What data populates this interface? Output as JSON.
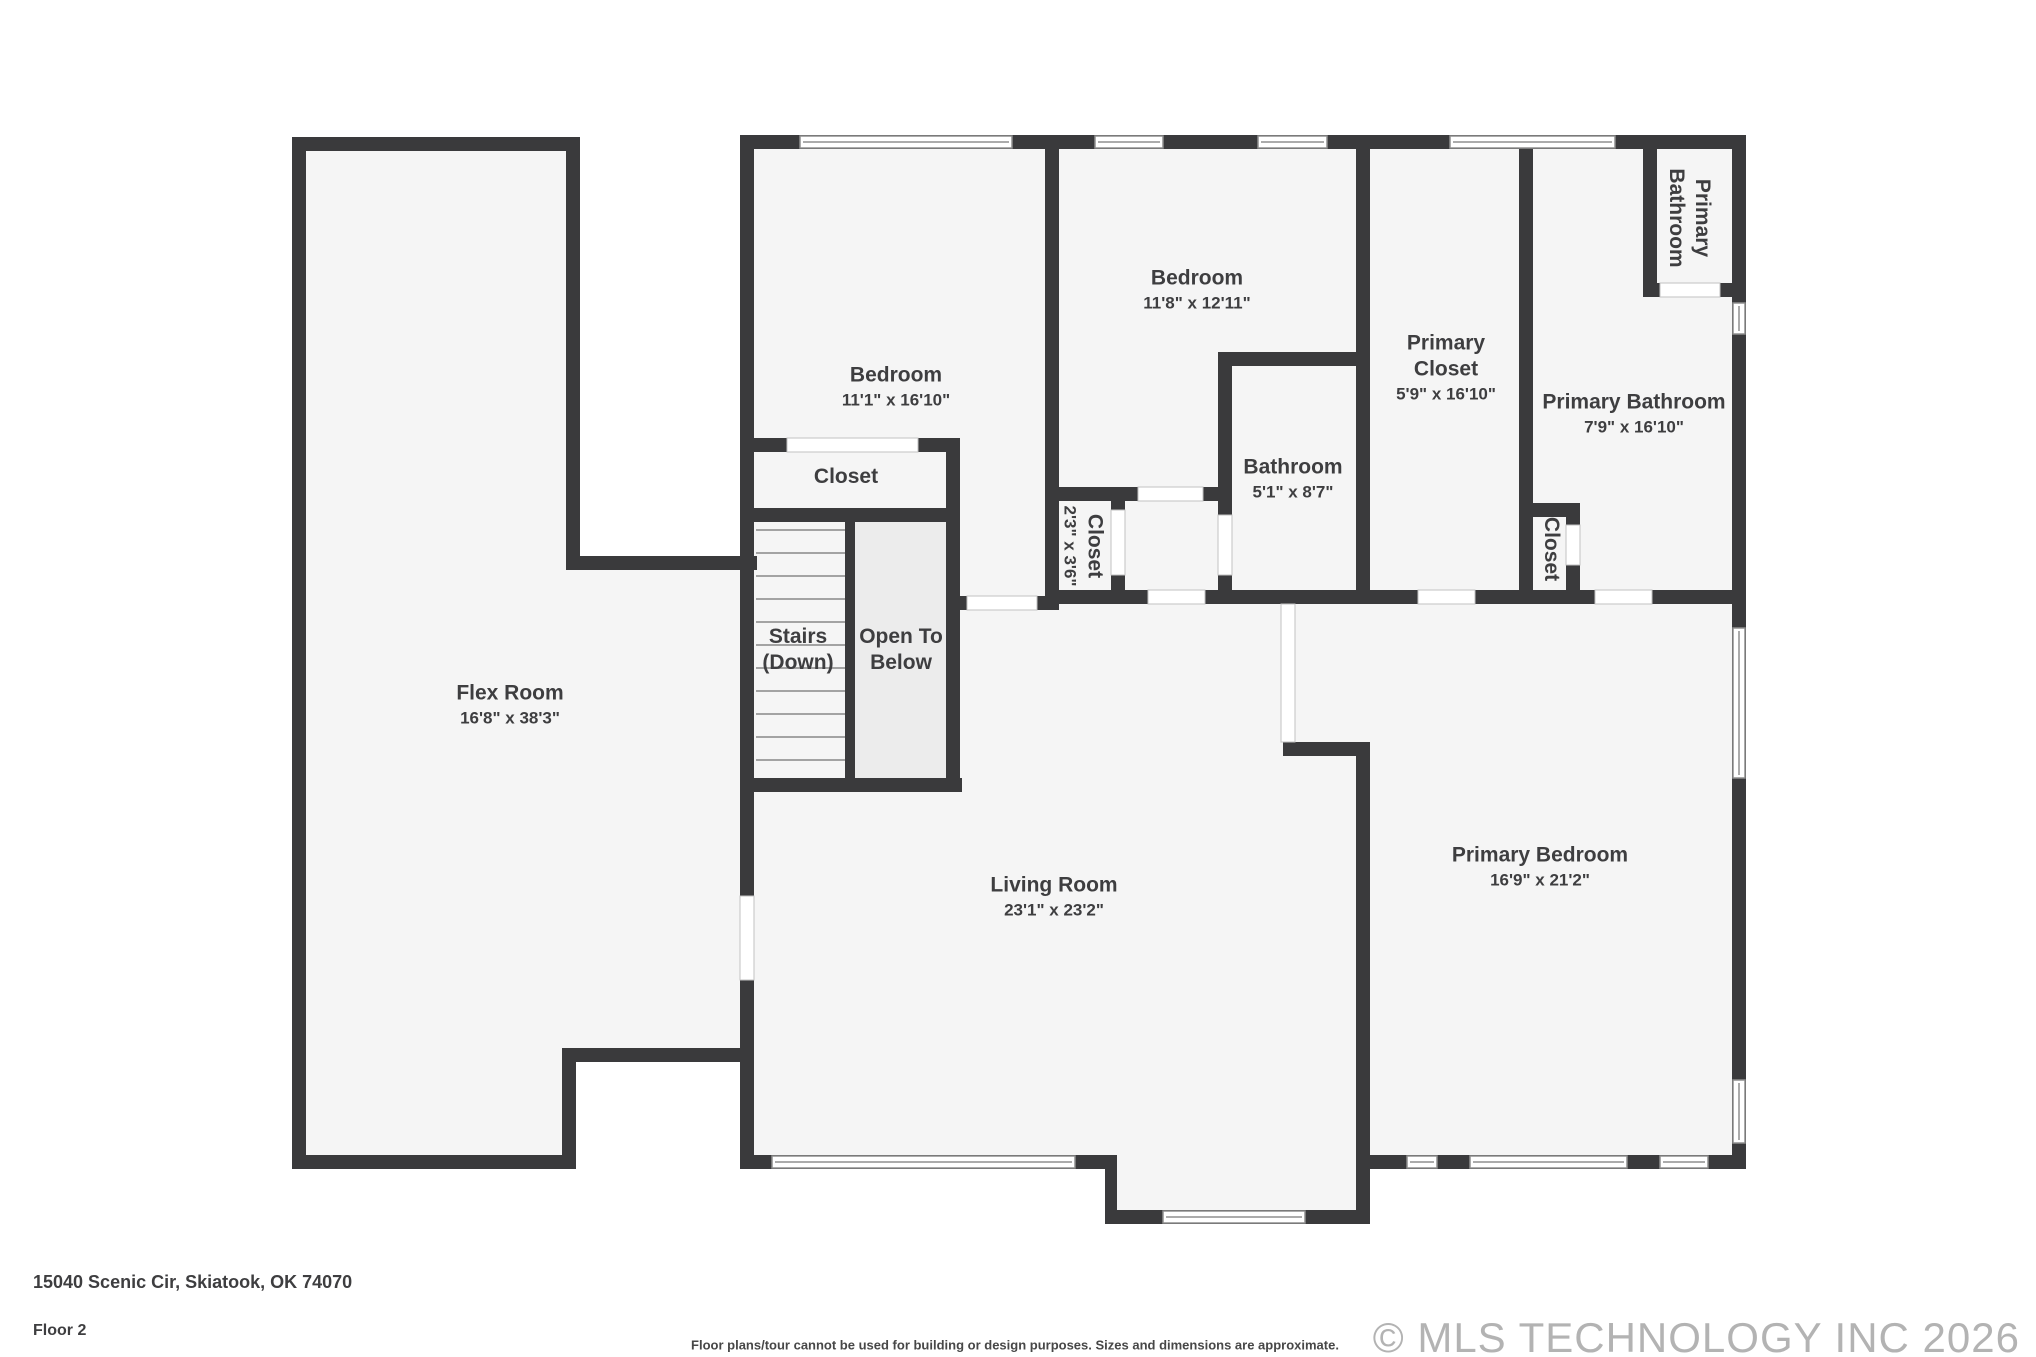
{
  "floorplan": {
    "address": "15040 Scenic Cir, Skiatook, OK 74070",
    "floor_label": "Floor 2",
    "disclaimer": "Floor plans/tour cannot be used for building or design purposes. Sizes and dimensions are approximate.",
    "copyright": "© MLS TECHNOLOGY INC 2026",
    "colors": {
      "wall-color": "#3a3a3c",
      "floor-color": "#f5f5f5",
      "otb-color": "#ececec",
      "label-color": "#3e3e40",
      "window-line-color": "#8f8f8f",
      "copyright-color": "#b3b3b3"
    },
    "rooms": [
      {
        "id": "flex-room",
        "line1": "Flex Room",
        "line2": "16'8\" x 38'3\""
      },
      {
        "id": "bedroom-1",
        "line1": "Bedroom",
        "line2": "11'1\" x 16'10\""
      },
      {
        "id": "bedroom-2",
        "line1": "Bedroom",
        "line2": "11'8\" x 12'11\""
      },
      {
        "id": "bedroom-closet",
        "line1": "Closet"
      },
      {
        "id": "stairs",
        "line1": "Stairs",
        "line2": "(Down)"
      },
      {
        "id": "open-to-below",
        "line1": "Open To",
        "line2": "Below"
      },
      {
        "id": "hall-closet",
        "line1": "Closet",
        "line2": "2'3\" x 3'6\""
      },
      {
        "id": "bathroom",
        "line1": "Bathroom",
        "line2": "5'1\" x 8'7\""
      },
      {
        "id": "primary-closet",
        "line1": "Primary",
        "line2": "Closet",
        "line3": "5'9\" x 16'10\""
      },
      {
        "id": "primary-bathroom",
        "line1": "Primary Bathroom",
        "line2": "7'9\" x 16'10\""
      },
      {
        "id": "primary-wc",
        "line1": "Primary",
        "line2": "Bathroom"
      },
      {
        "id": "primary-bath-closet",
        "line1": "Closet"
      },
      {
        "id": "living-room",
        "line1": "Living Room",
        "line2": "23'1\" x 23'2\""
      },
      {
        "id": "primary-bedroom",
        "line1": "Primary Bedroom",
        "line2": "16'9\" x 21'2\""
      }
    ]
  }
}
